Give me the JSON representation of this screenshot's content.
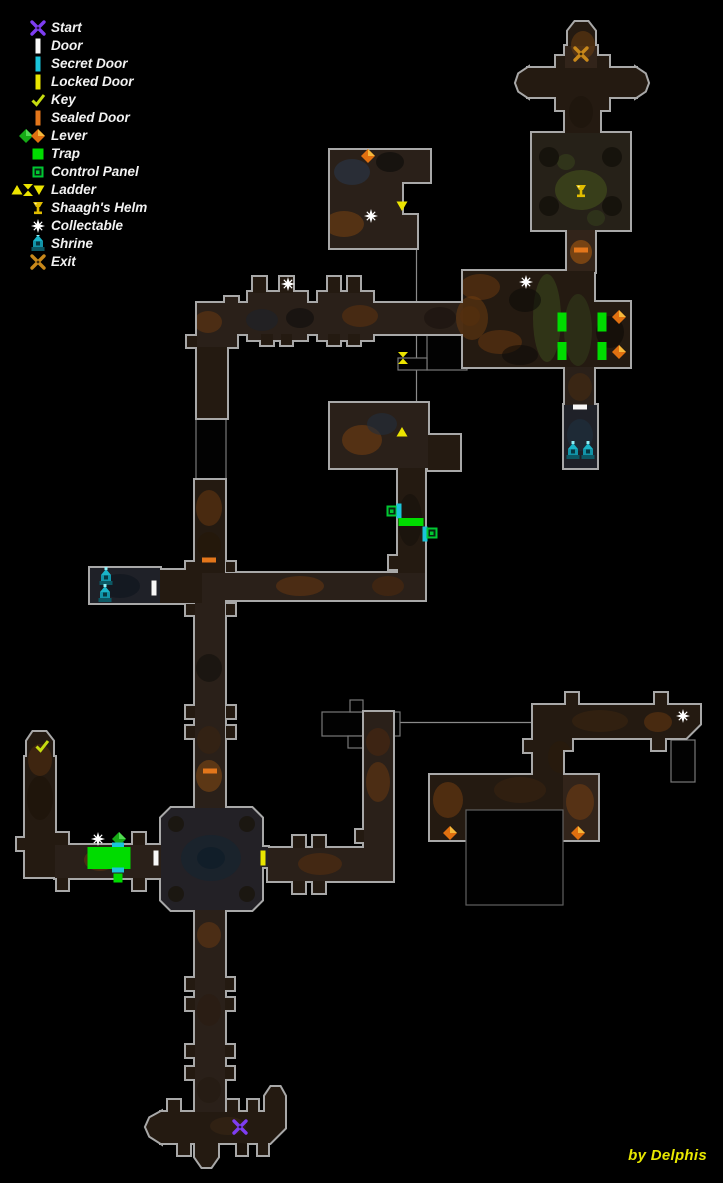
{
  "credit": "by Delphis",
  "colors": {
    "door": "#f8f8f8",
    "secret_door": "#1ac4da",
    "locked_door": "#e9e500",
    "sealed_door": "#e3761b",
    "trap": "#00dc00",
    "control_panel": "#00c832",
    "lever_orange": "#e07010",
    "lever_green": "#16aa16",
    "key": "#c6dc10",
    "ladder": "#ece400",
    "helm": "#e0bc00",
    "start": "#7e3df2",
    "exit": "#c8881a",
    "collectable": "#ffffff",
    "shrine": "#1ab4c8",
    "credit": "#e8e800"
  },
  "legend": {
    "items": [
      {
        "id": "start",
        "label": "Start",
        "icons": [
          "start-x"
        ]
      },
      {
        "id": "door",
        "label": "Door",
        "icons": [
          "door-v"
        ]
      },
      {
        "id": "secret-door",
        "label": "Secret Door",
        "icons": [
          "secret-v"
        ]
      },
      {
        "id": "locked-door",
        "label": "Locked Door",
        "icons": [
          "locked-v"
        ]
      },
      {
        "id": "key",
        "label": "Key",
        "icons": [
          "key"
        ]
      },
      {
        "id": "sealed-door",
        "label": "Sealed Door",
        "icons": [
          "sealed-v"
        ]
      },
      {
        "id": "lever",
        "label": "Lever",
        "icons": [
          "lever-g",
          "lever-o"
        ]
      },
      {
        "id": "trap",
        "label": "Trap",
        "icons": [
          "trap"
        ]
      },
      {
        "id": "control-panel",
        "label": "Control Panel",
        "icons": [
          "panel"
        ]
      },
      {
        "id": "ladder",
        "label": "Ladder",
        "icons": [
          "ladder-up",
          "ladder-x",
          "ladder-dn"
        ]
      },
      {
        "id": "shaaghs-helm",
        "label": "Shaagh's Helm",
        "icons": [
          "helm"
        ]
      },
      {
        "id": "collectable",
        "label": "Collectable",
        "icons": [
          "star"
        ]
      },
      {
        "id": "shrine",
        "label": "Shrine",
        "icons": [
          "shrine"
        ]
      },
      {
        "id": "exit",
        "label": "Exit",
        "icons": [
          "exit-x"
        ]
      }
    ]
  },
  "map": {
    "markers": [
      {
        "t": "exit-x",
        "x": 581,
        "y": 54
      },
      {
        "t": "helm",
        "x": 581,
        "y": 191
      },
      {
        "t": "sealed-h",
        "x": 581,
        "y": 250
      },
      {
        "t": "star",
        "x": 526,
        "y": 282
      },
      {
        "t": "trap",
        "x": 562,
        "y": 322,
        "w": 9,
        "h": 19
      },
      {
        "t": "trap",
        "x": 562,
        "y": 351,
        "w": 9,
        "h": 18
      },
      {
        "t": "trap",
        "x": 602,
        "y": 322,
        "w": 9,
        "h": 19
      },
      {
        "t": "trap",
        "x": 602,
        "y": 351,
        "w": 9,
        "h": 18
      },
      {
        "t": "lever-o",
        "x": 619,
        "y": 317
      },
      {
        "t": "lever-o",
        "x": 619,
        "y": 352
      },
      {
        "t": "door-h",
        "x": 580,
        "y": 407
      },
      {
        "t": "shrine",
        "x": 573,
        "y": 452
      },
      {
        "t": "shrine",
        "x": 588,
        "y": 452
      },
      {
        "t": "lever-o",
        "x": 368,
        "y": 156
      },
      {
        "t": "ladder-dn",
        "x": 402,
        "y": 206
      },
      {
        "t": "star",
        "x": 371,
        "y": 216
      },
      {
        "t": "star",
        "x": 288,
        "y": 284
      },
      {
        "t": "ladder-x",
        "x": 403,
        "y": 358
      },
      {
        "t": "ladder-up",
        "x": 402,
        "y": 432
      },
      {
        "t": "panel",
        "x": 392,
        "y": 511
      },
      {
        "t": "secret-v",
        "x": 399,
        "y": 511
      },
      {
        "t": "trap",
        "x": 411,
        "y": 522,
        "w": 25,
        "h": 8
      },
      {
        "t": "secret-v",
        "x": 425,
        "y": 534
      },
      {
        "t": "panel",
        "x": 432,
        "y": 533
      },
      {
        "t": "sealed-h",
        "x": 209,
        "y": 560
      },
      {
        "t": "shrine",
        "x": 106,
        "y": 578
      },
      {
        "t": "shrine",
        "x": 105,
        "y": 595
      },
      {
        "t": "door-v",
        "x": 154,
        "y": 588
      },
      {
        "t": "sealed-h",
        "x": 210,
        "y": 771
      },
      {
        "t": "key",
        "x": 42,
        "y": 746
      },
      {
        "t": "star",
        "x": 98,
        "y": 839
      },
      {
        "t": "lever-g",
        "x": 119,
        "y": 839
      },
      {
        "t": "secret-h",
        "x": 118,
        "y": 845
      },
      {
        "t": "trap",
        "x": 109,
        "y": 858,
        "w": 43,
        "h": 22
      },
      {
        "t": "secret-h",
        "x": 118,
        "y": 870
      },
      {
        "t": "trap",
        "x": 118,
        "y": 878,
        "w": 9,
        "h": 9
      },
      {
        "t": "door-v",
        "x": 156,
        "y": 858
      },
      {
        "t": "locked-v",
        "x": 263,
        "y": 858
      },
      {
        "t": "star",
        "x": 683,
        "y": 716
      },
      {
        "t": "lever-o",
        "x": 450,
        "y": 833
      },
      {
        "t": "lever-o",
        "x": 578,
        "y": 833
      },
      {
        "t": "start-x",
        "x": 240,
        "y": 1127
      }
    ]
  }
}
